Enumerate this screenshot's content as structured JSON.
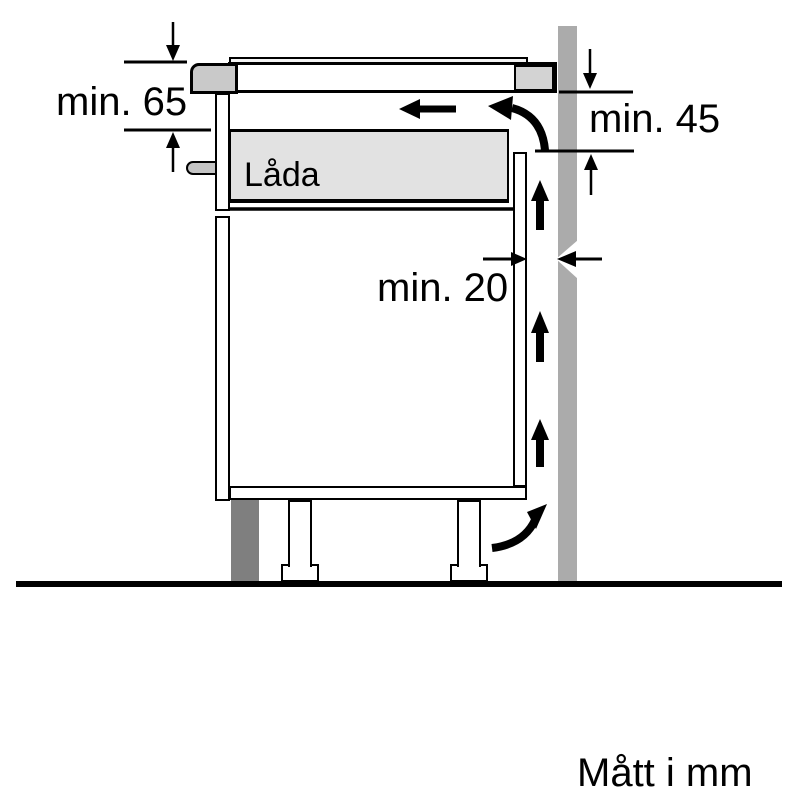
{
  "diagram": {
    "type": "appliance-installation-side-view",
    "labels": {
      "dim_worktop_to_drawer": "min. 65",
      "dim_wall_side": "min. 45",
      "dim_back_gap": "min. 20",
      "drawer": "Låda",
      "units_note": "Mått i mm"
    },
    "colors": {
      "line": "#000000",
      "wall": "#ababab",
      "plinth_fill": "#7f7f7f",
      "drawer_fill": "#e2e2e2",
      "hob_fill": "#c9c9c9",
      "handle_fill": "#c4c4c4",
      "worktop_end_fill": "#d3d3d3"
    }
  }
}
